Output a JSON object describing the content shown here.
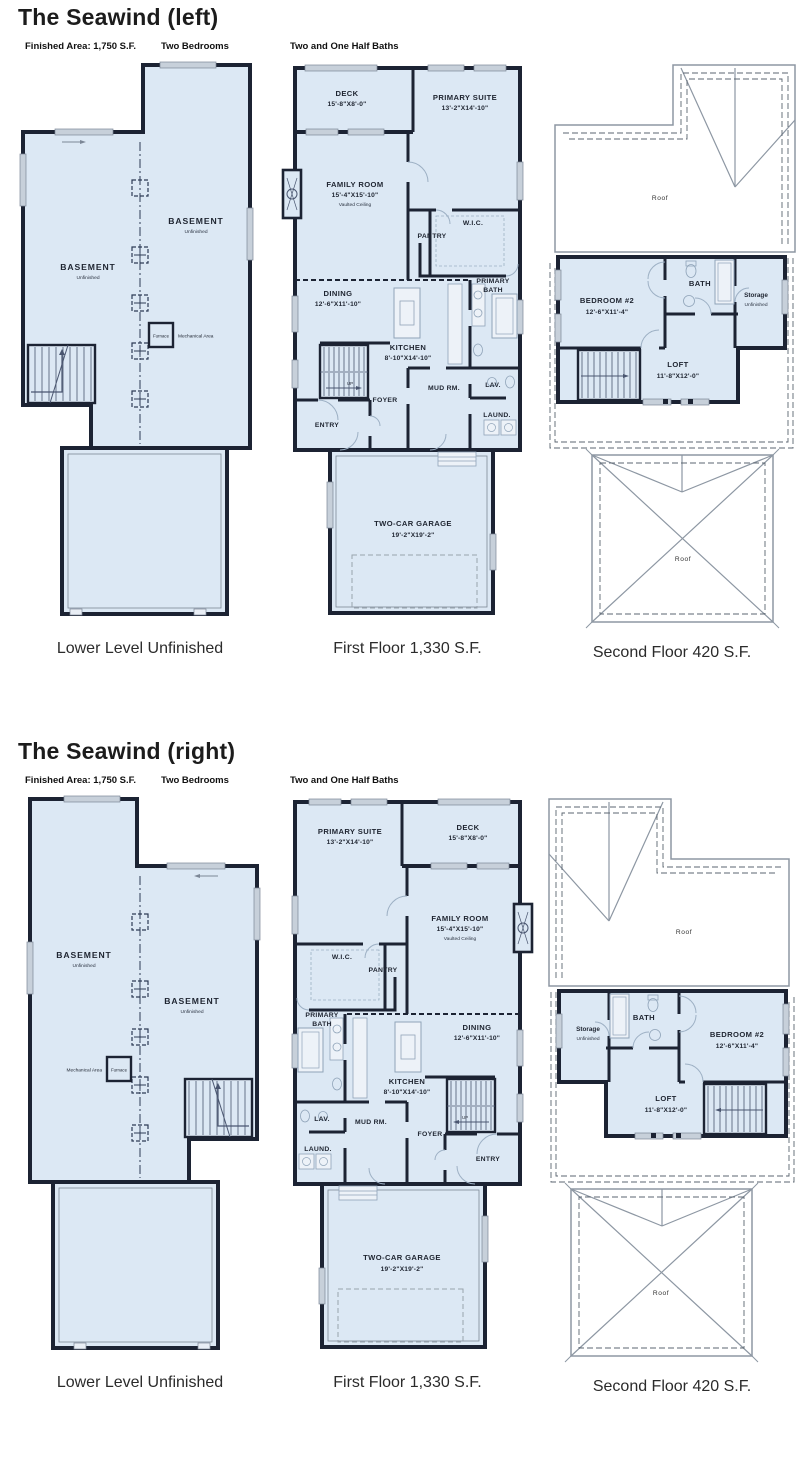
{
  "sections": [
    {
      "title": "The Seawind (left)"
    },
    {
      "title": "The Seawind (right)"
    }
  ],
  "stats": {
    "area": "Finished Area: 1,750 S.F.",
    "bedrooms": "Two Bedrooms",
    "baths": "Two and One Half Baths"
  },
  "captions": {
    "lower": "Lower Level Unfinished",
    "first": "First Floor 1,330 S.F.",
    "second": "Second Floor 420 S.F."
  },
  "labels": {
    "basement": "BASEMENT",
    "unfinished": "Unfinished",
    "furnace": "Furnace",
    "mechanical_area": "Mechanical Area",
    "deck": "DECK",
    "deck_dims": "15'-8\"X8'-0\"",
    "primary_suite": "PRIMARY SUITE",
    "primary_suite_dims": "13'-2\"X14'-10\"",
    "family_room": "FAMILY ROOM",
    "family_room_dims": "15'-4\"X15'-10\"",
    "vaulted": "Vaulted Ceiling",
    "wic": "W.I.C.",
    "pantry": "PANTRY",
    "dining": "DINING",
    "dining_dims": "12'-6\"X11'-10\"",
    "primary": "PRIMARY",
    "bath": "BATH",
    "kitchen": "KITCHEN",
    "kitchen_dims": "8'-10\"X14'-10\"",
    "mud": "MUD RM.",
    "lav": "LAV.",
    "foyer": "FOYER",
    "entry": "ENTRY",
    "laund": "LAUND.",
    "up": "UP",
    "garage": "TWO-CAR GARAGE",
    "garage_dims": "19'-2\"X19'-2\"",
    "roof": "Roof",
    "bedroom2": "BEDROOM #2",
    "bedroom2_dims": "12'-6\"X11'-4\"",
    "storage": "Storage",
    "loft": "LOFT",
    "loft_dims": "11'-8\"X12'-0\""
  },
  "colors": {
    "floor_fill": "#dce8f4",
    "wall": "#1c2333",
    "roof_line": "#8d97a3",
    "column_dash": "#2c3a55",
    "fixture": "#8fa3b8",
    "window_fill": "#c7d0da",
    "text": "#1e2430"
  }
}
